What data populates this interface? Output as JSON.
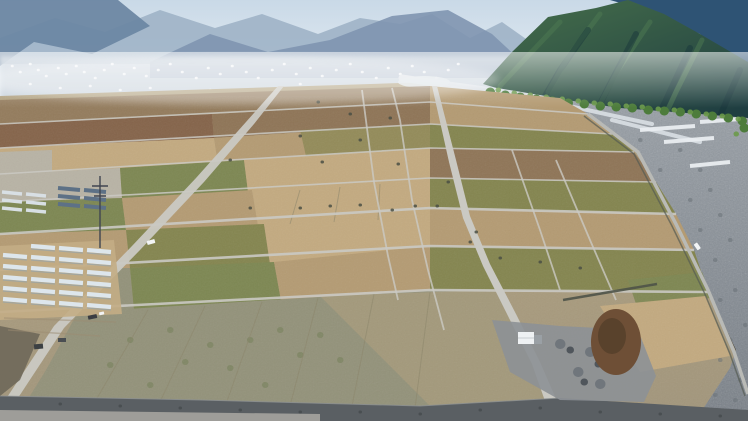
{
  "scene": {
    "label": "Aerial drone view of a rebuilt farmland grid in a mountain valley beside a braided gravel river, town in hazy distance, greenhouses lower left"
  },
  "palette": {
    "sky_top": "#c9d9e7",
    "sky_bottom": "#eef3f7",
    "ridge_far": "#9fb2c6",
    "ridge_left": "#6d87a3",
    "ridge_mid": "#8095b0",
    "town_haze": "#c6d0da",
    "town_white": "#f3f6f8",
    "town_green": "#9ab386",
    "ridge_right_blue": "#2e5374",
    "mountain_lit": "#47704b",
    "mountain_dark": "#1f3e41",
    "mountain_highlight": "#4e7a52",
    "mountain_shadow": "#16323a",
    "trees_green": "#4d7c3c",
    "trees_light": "#6b9a4a",
    "river_top": "#9aa1a8",
    "river_bottom": "#767d85",
    "river_rock": "#666d74",
    "water_light": "#dde3e8",
    "plastic_white": "#e9edf0",
    "valley_top": "#b2a27f",
    "valley_bottom": "#a2967c",
    "field_tan": "#b49b73",
    "field_tan_light": "#c3aa80",
    "field_olive": "#84854f",
    "field_green": "#7d8752",
    "field_graygreen": "#93927a",
    "field_brown": "#8f7557",
    "rubble_brown": "#85644a",
    "field_pale": "#b8b3a5",
    "field_fg_tan": "#a89b7c",
    "field_mottle": "#6d7a4e",
    "road_light": "#cac9c3",
    "road_edge": "#565b52",
    "levee_dark": "#5a5f63",
    "track_light": "#a5a49e",
    "rock_brown": "#6b6557",
    "gravel": "#8d9196",
    "gravel_mound": "#70767c",
    "gravel_dark": "#50565c",
    "pit_brown": "#6e4f36",
    "pit_dark": "#57402b",
    "greenhouse_white": "#dde6ec",
    "greenhouse_shadow": "#8fa3b0",
    "greenhouse_blue": "#5d7186",
    "greenhouse_pale": "#d8dfe4",
    "shed_white": "#eef1f3",
    "annex_gray": "#9aa0a5",
    "pylon_dark": "#404550",
    "vehicle_white": "#f2f4f5",
    "vehicle_dark": "#3a3d42",
    "debris_dark": "#4a4f44",
    "haze_white": "#ffffff"
  }
}
